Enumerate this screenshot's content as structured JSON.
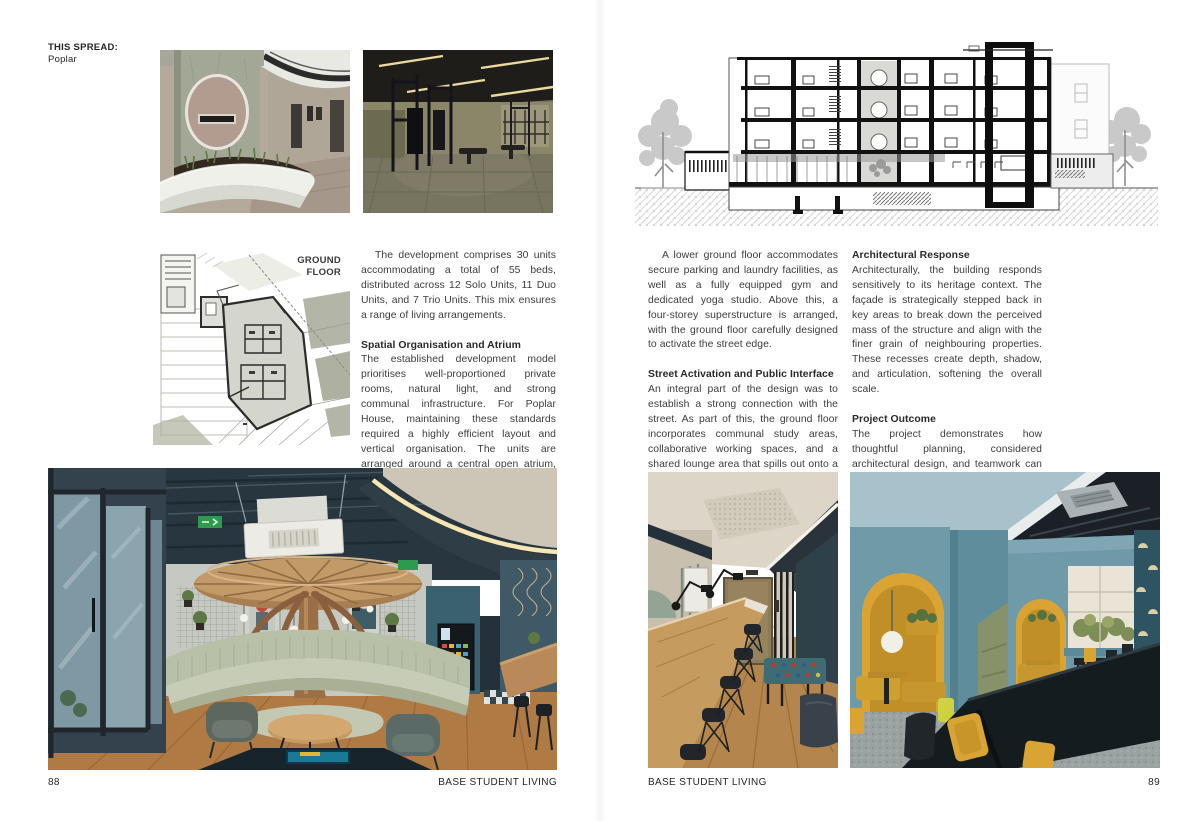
{
  "palette": {
    "paper": "#ffffff",
    "ink": "#2b2b2b",
    "body_text": "#3d3d3d",
    "sage": "#b9c0a8",
    "mustard": "#d9a434",
    "teal": "#3f6b74",
    "wood": "#b5854e"
  },
  "page_left": {
    "spread_label_title": "THIS SPREAD:",
    "spread_label_value": "Poplar",
    "plan_label_line1": "GROUND",
    "plan_label_line2": "FLOOR",
    "column": {
      "para1": "The development comprises 30 units accommodating a total of 55 beds, distributed across 12 Solo Units, 11 Duo Units, and 7 Trio Units. This mix ensures a range of living arrangements.",
      "heading1": "Spatial Organisation and Atrium",
      "para2": "The established development model prioritises well-proportioned private rooms, natural light, and strong communal infrastructure. For Poplar House, maintaining these standards required a highly efficient layout and vertical organisation. The units are arranged around a central open atrium, which brings daylight and fresh air into the building and establishes visual connectivity between levels. The building is organised across five levels."
    },
    "footer_page_number": "88",
    "footer_title": "BASE STUDENT LIVING"
  },
  "page_right": {
    "section_label_line1": "POPLAR",
    "section_label_line2": "SECTION",
    "column1": {
      "para1": "A lower ground floor accommodates secure parking and laundry facilities, as well as a fully equipped gym and dedicated yoga studio. Above this, a four-storey superstructure is arranged, with the ground floor carefully designed to activate the street edge.",
      "heading1": "Street Activation and Public Interface",
      "para2": "An integral part of the design was to establish a strong connection with the street. As part of this, the ground floor incorporates communal study areas, collaborative working spaces, and a shared lounge area that spills out onto a terrace and braai area that visually and physically engage the public realm. This activation of the street edge strengthens safety and promotes permeability."
    },
    "column2": {
      "heading1": "Architectural Response",
      "para1": "Architecturally, the building responds sensitively to its heritage context. The façade is strategically stepped back in key areas to break down the perceived mass of the structure and align with the finer grain of neighbouring properties. These recesses create depth, shadow, and articulation, softening the overall scale.",
      "heading2": "Project Outcome",
      "para2": "The project demonstrates how thoughtful planning, considered architectural design, and teamwork can unlock the full potential of a restricted site while remaining aligned with a clear development philosophy. Abacus Group has set a high bar for student accommodation."
    },
    "footer_title": "BASE STUDENT LIVING",
    "footer_page_number": "89"
  }
}
